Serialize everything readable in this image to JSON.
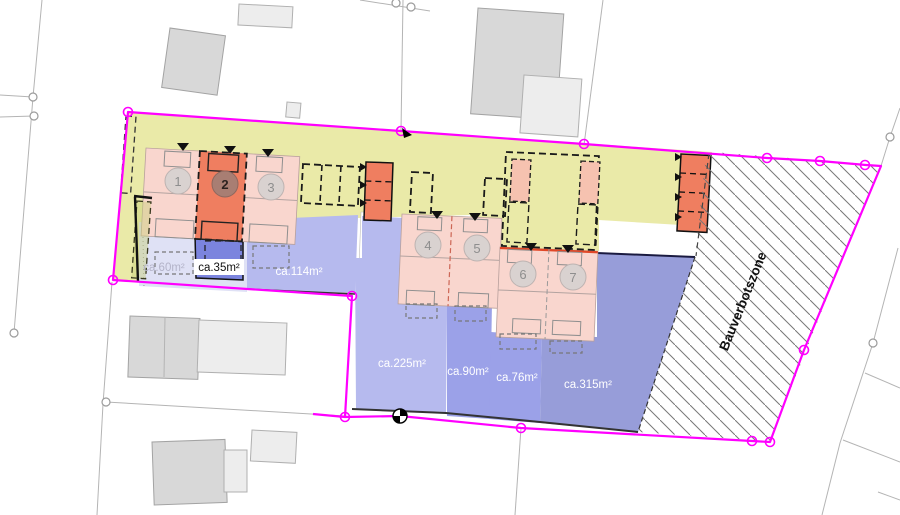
{
  "site_plan": {
    "unit_numbers": [
      "1",
      "2",
      "3",
      "4",
      "5",
      "6",
      "7"
    ],
    "area_labels": [
      "ca.60m²",
      "ca.35m²",
      "ca.114m²",
      "ca.225m²",
      "ca.90m²",
      "ca.76m²",
      "ca.315m²"
    ],
    "zone_label": "Bauverbotszone",
    "colors": {
      "boundary_magenta": "#ff00ff",
      "zone_yellow": "#eaeaa8",
      "house_pink": "#f9d6ce",
      "strip_pink": "#f6c2b0",
      "garage_orange": "#ef7e60",
      "garden_pale": "#dfe1f5",
      "garden_light": "#b6baee",
      "garden_medium": "#9ba1e8",
      "garden_dark": "#979dd9",
      "garden_small_blue": "#7b84de",
      "hatch_line": "#777777"
    }
  }
}
